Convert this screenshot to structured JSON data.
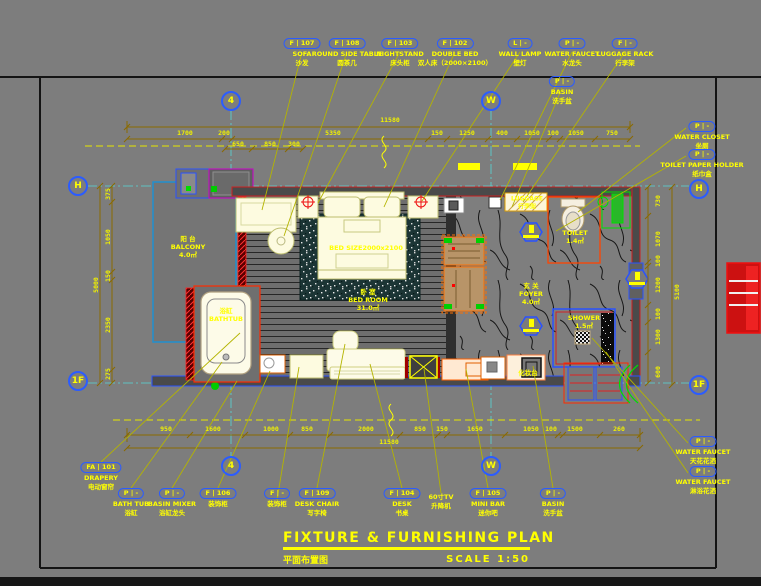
{
  "title": {
    "en": "FIXTURE & FURNISHING PLAN",
    "zh": "平面布置图",
    "scale": "SCALE 1:50"
  },
  "grid": {
    "col_a": "4",
    "col_b": "W",
    "row_top": "H",
    "row_bottom": "1F"
  },
  "callouts": {
    "sofa": {
      "code": "F | 107",
      "en": "SOFA",
      "zh": "沙发"
    },
    "round_side_table": {
      "code": "F | 108",
      "en": "ROUND SIDE TABLE",
      "zh": "圆茶几"
    },
    "nightstand": {
      "code": "F | 103",
      "en": "NIGHTSTAND",
      "zh": "床头柜"
    },
    "double_bed": {
      "code": "F | 102",
      "en": "DOUBLE BED",
      "zh": "双人床（2000×2100）"
    },
    "wall_lamp": {
      "code": "L | -",
      "en": "WALL LAMP",
      "zh": "壁灯"
    },
    "water_faucet_top": {
      "code": "P | -",
      "en": "WATER FAUCET",
      "zh": "水龙头"
    },
    "luggage_rack": {
      "code": "F | -",
      "en": "LUGGAGE RACK",
      "zh": "行李架"
    },
    "basin_top": {
      "code": "P | -",
      "en": "BASIN",
      "zh": "洗手盆"
    },
    "water_closet": {
      "code": "P | -",
      "en": "WATER CLOSET",
      "zh": "坐厕"
    },
    "toilet_paper_holder": {
      "code": "P | -",
      "en": "TOILET PAPER HOLDER",
      "zh": "纸巾盒"
    },
    "water_faucet_ceiling": {
      "code": "P | -",
      "en": "WATER FAUCET",
      "zh": "天花花洒"
    },
    "water_faucet_shower": {
      "code": "P | -",
      "en": "WATER FAUCET",
      "zh": "淋浴花洒"
    },
    "drapery": {
      "code": "FA | 101",
      "en": "DRAPERY",
      "zh": "电动窗帘"
    },
    "bath_tub": {
      "code": "P | -",
      "en": "BATH TUB",
      "zh": "浴缸"
    },
    "basin_mixer": {
      "code": "P | -",
      "en": "BASIN MIXER",
      "zh": "浴缸龙头"
    },
    "deco_cabinet_1": {
      "code": "F | 106",
      "zh": "装饰柜"
    },
    "deco_cabinet_2": {
      "code": "F | -",
      "zh": "装饰柜"
    },
    "desk_chair": {
      "code": "F | 109",
      "en": "DESK CHAIR",
      "zh": "写字椅"
    },
    "desk": {
      "code": "F | 104",
      "en": "DESK",
      "zh": "书桌"
    },
    "tv_lift": {
      "line1": "60寸TV",
      "line2": "升降机"
    },
    "mini_bar": {
      "code": "F | 105",
      "en": "MINI BAR",
      "zh": "迷你吧"
    },
    "basin_bottom": {
      "code": "P | -",
      "en": "BASIN",
      "zh": "洗手盆"
    }
  },
  "rooms": {
    "balcony": {
      "zh": "阳 台",
      "en": "BALCONY",
      "area": "4.0㎡"
    },
    "bedroom": {
      "zh": "卧 室",
      "en": "BED ROOM",
      "area": "31.0㎡"
    },
    "foyer": {
      "zh": "玄 关",
      "en": "FOYER",
      "area": "4.0㎡"
    },
    "toilet": {
      "en": "TOILET",
      "area": "1.4㎡"
    },
    "shower": {
      "en": "SHOWER",
      "area": "1.5㎡"
    },
    "bathtub": {
      "zh": "浴缸",
      "en": "BATHTUB"
    },
    "vanity": {
      "zh": "化妆台"
    },
    "luggage": {
      "en": "LUGGAGE",
      "zh": "行李架"
    },
    "bed_size": "BED SIZE2000x2100"
  },
  "dims": {
    "top_total": "11580",
    "top_row": [
      "1700",
      "200",
      "5350",
      "150",
      "1250",
      "400",
      "1050",
      "100",
      "1050",
      "750"
    ],
    "top_sub": [
      "650",
      "850",
      "300"
    ],
    "bottom_row": [
      "950",
      "1600",
      "1000",
      "850",
      "2000",
      "850",
      "150",
      "1650",
      "1050",
      "100",
      "1500",
      "260"
    ],
    "bottom_total": "11580",
    "left_col": [
      "375",
      "1050",
      "150",
      "2350",
      "275"
    ],
    "left_total": "5000",
    "right_col": [
      "730",
      "1070",
      "100",
      "1200",
      "100",
      "1300",
      "600"
    ],
    "right_total": "5100"
  }
}
